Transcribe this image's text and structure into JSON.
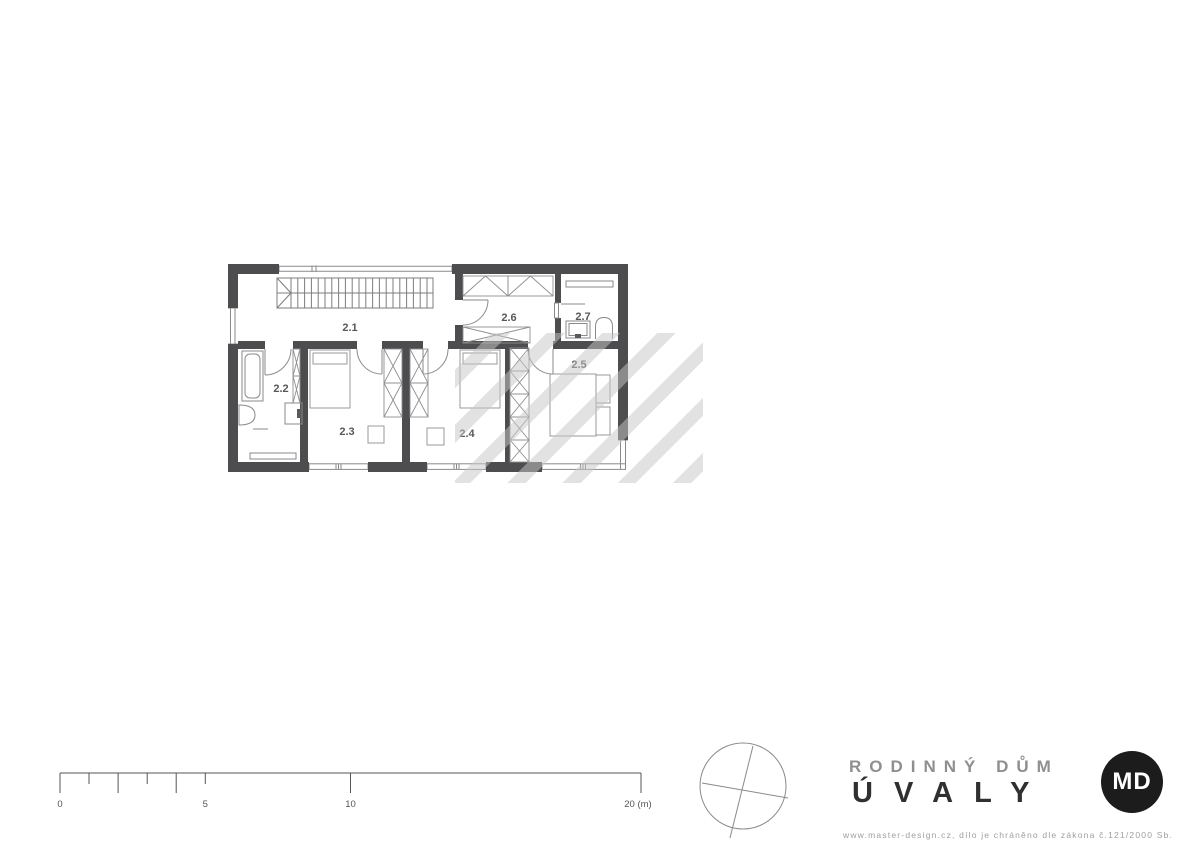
{
  "plan": {
    "name": "second floor plan",
    "rooms": [
      {
        "label": "2.1"
      },
      {
        "label": "2.2"
      },
      {
        "label": "2.3"
      },
      {
        "label": "2.4"
      },
      {
        "label": "2.5"
      },
      {
        "label": "2.6"
      },
      {
        "label": "2.7"
      }
    ]
  },
  "scale_bar": {
    "labels": [
      "0",
      "5",
      "10",
      "20 (m)"
    ],
    "ticks_m": [
      0,
      1,
      2,
      3,
      4,
      5,
      10,
      20
    ]
  },
  "title_block": {
    "project": "RODINNÝ DŮM",
    "location": "ÚVALY",
    "logo": "MD",
    "copyright": "www.master-design.cz, dílo je chráněno dle zákona č.121/2000 Sb."
  },
  "colors": {
    "wall": "#4d4d50",
    "furniture_line": "#9a9a9a",
    "fixture_line": "#8a8a8a",
    "room_label": "#58585a",
    "title_primary": "#8f8f8f",
    "title_secondary": "#303030",
    "logo_background": "#1c1c1c",
    "logo_text": "#ffffff",
    "footer_text": "#9e9e9e",
    "scale_line": "#555555",
    "watermark_stripe": "#c6c6c6"
  }
}
